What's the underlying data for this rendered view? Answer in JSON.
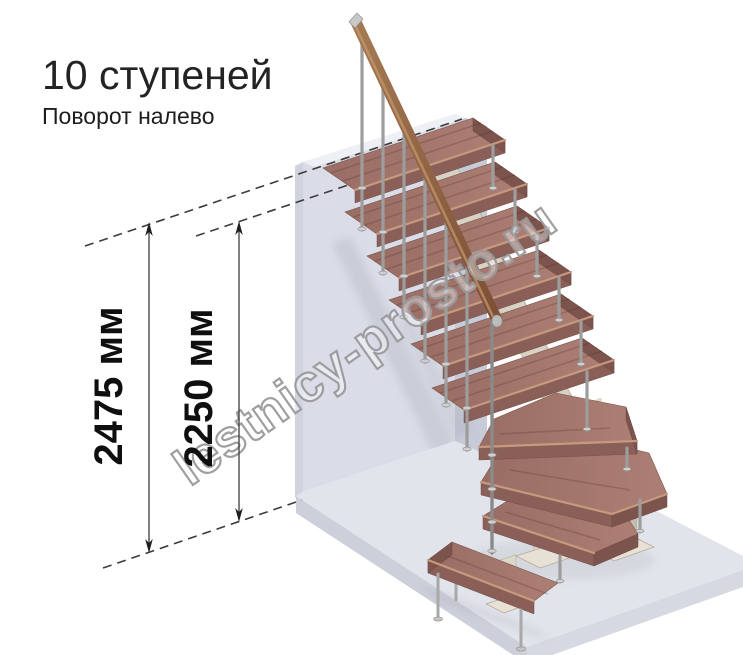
{
  "title": "10 ступеней",
  "subtitle": "Поворот налево",
  "dims": [
    {
      "name": "total-height",
      "label": "2475 мм"
    },
    {
      "name": "landing-height",
      "label": "2250 мм"
    }
  ],
  "watermark": "lestnicy-prosto.ru",
  "stairs": {
    "turn": "налево",
    "steps_label": "10 ступеней"
  },
  "colors": {
    "wall": "#dadde7",
    "wall_side": "#c7cbd7",
    "wall_top": "#eef0f5",
    "floor": "#e2e4eb",
    "floor_face": "#ccd0da",
    "wood_top": "#a1756c",
    "wood_front": "#8a5f57",
    "metal": "#9d9d9d",
    "support_beige": "#d8d2c4",
    "handrail": "#8a5a40",
    "annotation": "#3c3c3c",
    "watermark_outline": "#9a9a9e"
  }
}
